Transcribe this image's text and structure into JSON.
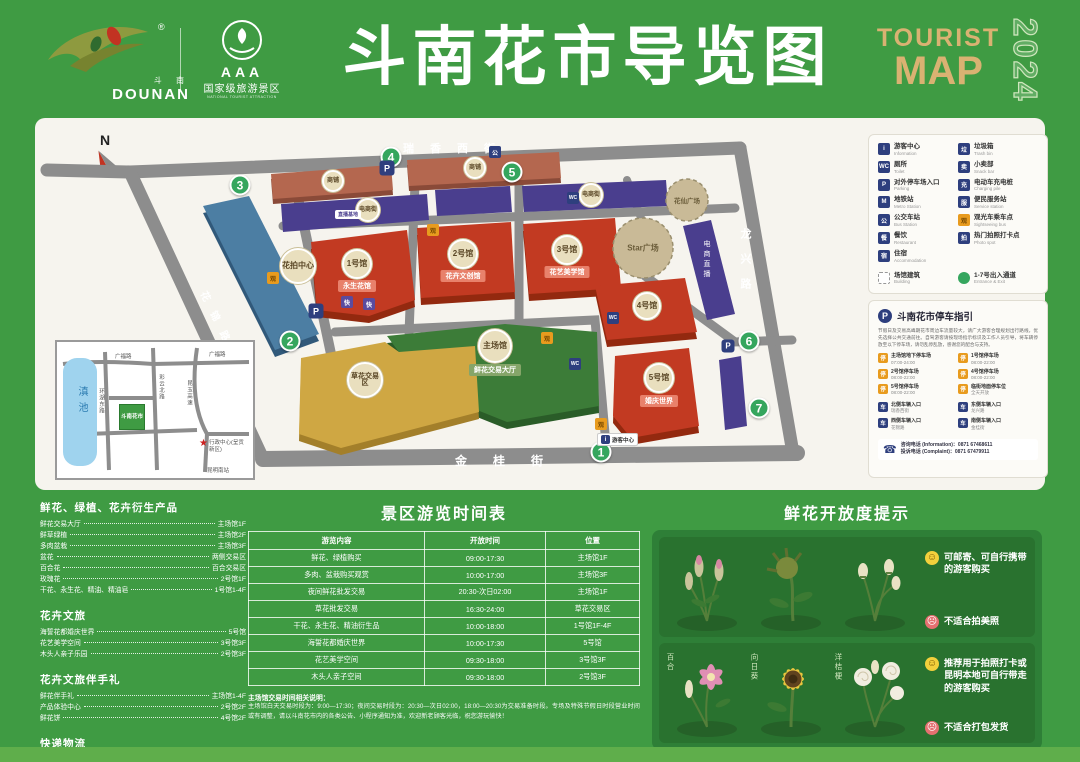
{
  "header": {
    "logo": {
      "cn": "斗 南",
      "en": "DOUNAN",
      "reg": "®"
    },
    "aaa": {
      "grade": "AAA",
      "cn": "国家级旅游景区",
      "en": "NATIONAL TOURIST ATTRACTION"
    },
    "title": "斗南花市导览图",
    "tourist": "TOURIST",
    "map_word": "MAP",
    "year": "2024"
  },
  "icons": {
    "info": "i",
    "toilet": "WC",
    "parking": "P",
    "metro": "M",
    "bus": "公",
    "restaurant": "餐",
    "hotel": "宿",
    "trash": "垃",
    "snack": "卖",
    "charge": "充",
    "service": "服",
    "sight": "观",
    "photo": "拍",
    "gate": "车",
    "lot": "停",
    "express": "快",
    "phone": "☎",
    "star": "★"
  },
  "map": {
    "compass": "N",
    "streets": {
      "top": "瑞香西街",
      "bottom": "金桂街",
      "right": "龙兴路",
      "left": "花锦路"
    },
    "entrances": [
      "1",
      "2",
      "3",
      "4",
      "5",
      "6",
      "7"
    ],
    "buildings": {
      "blue": {
        "badge": "花拍中心"
      },
      "salmon_a": {
        "badge": "商铺"
      },
      "salmon_b": {
        "badge": "商铺"
      },
      "purple1": {
        "badge": "电商街"
      },
      "purple2": {
        "badge": "电商街"
      },
      "ecommerce": {
        "label": "直播基地",
        "side": "电商直播"
      },
      "hall1": {
        "badge": "1号馆",
        "banner": "永生花馆"
      },
      "hall2": {
        "badge": "2号馆",
        "banner": "花卉文创馆"
      },
      "hall3": {
        "badge": "3号馆",
        "banner": "花艺美学馆"
      },
      "hall4": {
        "badge": "4号馆"
      },
      "hall5": {
        "badge": "5号馆",
        "banner": "婚庆世界"
      },
      "main": {
        "badge": "主场馆",
        "banner": "鲜花交易大厅"
      },
      "yellow": {
        "badge": "草花交易区"
      },
      "plaza_star": {
        "label": "Star广场"
      },
      "plaza_small": {
        "label": "花仙广场"
      }
    },
    "poi": {
      "visitor_center": "游客中心"
    },
    "inset": {
      "lake": "滇池",
      "road_tl": "广福路",
      "road_tr": "广福路",
      "road_left": "环湖东路",
      "road_mid": "彩云北路",
      "road_right": "昆玉高速",
      "marker": "斗南花市",
      "star_label": "行政中心(呈贡新区)",
      "station": "昆明南站"
    }
  },
  "legend": {
    "left": [
      {
        "cn": "游客中心",
        "en": "Information"
      },
      {
        "cn": "厕所",
        "en": "Toilet"
      },
      {
        "cn": "对外停车场入口",
        "en": "Parking"
      },
      {
        "cn": "地铁站",
        "en": "Metro Station"
      },
      {
        "cn": "公交车站",
        "en": "Bus Station"
      },
      {
        "cn": "餐饮",
        "en": "Restaurant"
      },
      {
        "cn": "住宿",
        "en": "Accommodation"
      }
    ],
    "right": [
      {
        "cn": "垃圾箱",
        "en": "Trash bin"
      },
      {
        "cn": "小卖部",
        "en": "Snack bar"
      },
      {
        "cn": "电动车充电桩",
        "en": "Charging pile"
      },
      {
        "cn": "便民服务站",
        "en": "Service station"
      },
      {
        "cn": "观光车乘车点",
        "en": "Sightseeing bus"
      },
      {
        "cn": "热门拍照打卡点",
        "en": "Photo spot"
      }
    ],
    "bottom": [
      {
        "cn": "场馆建筑",
        "en": "Building"
      },
      {
        "cn": "1-7号出入通道",
        "en": "Entrance & Exit"
      }
    ]
  },
  "parking": {
    "title": "斗南花市停车指引",
    "intro": "节假日及交易高峰期花市周边车流量较大，请广大游客合理规划出行路线，优先选择公共交通前往。自驾游客请按现场指示标识及工作人员引导，将车辆停放至以下停车场，请勿乱停乱放，感谢您的配合与支持。",
    "lots": [
      {
        "name": "主场馆地下停车场",
        "time": "07:00-24:00"
      },
      {
        "name": "1号馆停车场",
        "time": "08:00-22:00"
      },
      {
        "name": "2号馆停车场",
        "time": "08:00-22:00"
      },
      {
        "name": "4号馆停车场",
        "time": "08:00-22:00"
      },
      {
        "name": "5号馆停车场",
        "time": "08:00-22:00"
      },
      {
        "name": "临街地面停车位",
        "time": "全天开放"
      }
    ],
    "gates": [
      {
        "name": "北侧车辆入口",
        "road": "瑞香西街"
      },
      {
        "name": "东侧车辆入口",
        "road": "龙兴路"
      },
      {
        "name": "西侧车辆入口",
        "road": "花锦路"
      },
      {
        "name": "南侧车辆入口",
        "road": "金桂街"
      }
    ],
    "phones": {
      "info_line": "咨询电话 (Information)：0871 67468611",
      "complaint_line": "投诉电话 (Complaint)：0871 67479911"
    }
  },
  "products": {
    "s1": {
      "title": "鲜花、绿植、花卉衍生产品",
      "items": [
        {
          "n": "鲜花交易大厅",
          "l": "主场馆1F"
        },
        {
          "n": "鲜草绿植",
          "l": "主场馆2F"
        },
        {
          "n": "多肉盆栽",
          "l": "主场馆3F"
        },
        {
          "n": "盆花",
          "l": "两侧交易区"
        },
        {
          "n": "百合花",
          "l": "百合交易区"
        },
        {
          "n": "玫瑰花",
          "l": "2号馆1F"
        },
        {
          "n": "干花、永生花、精油、精油皂",
          "l": "1号馆1-4F"
        }
      ]
    },
    "s2": {
      "title": "花卉文旅",
      "items": [
        {
          "n": "海誓花都婚庆世界",
          "l": "5号馆"
        },
        {
          "n": "花艺美学空间",
          "l": "3号馆3F"
        },
        {
          "n": "木头人亲子乐园",
          "l": "2号馆3F"
        }
      ]
    },
    "s3": {
      "title": "花卉文旅伴手礼",
      "items": [
        {
          "n": "鲜花伴手礼",
          "l": "主场馆1-4F"
        },
        {
          "n": "产品体验中心",
          "l": "2号馆2F"
        },
        {
          "n": "鲜花饼",
          "l": "4号馆2F"
        }
      ]
    },
    "s4": {
      "title": "快递物流",
      "items": [
        {
          "n": "中通快递",
          "l": "主场馆1F"
        },
        {
          "n": "申通快递",
          "l": "1号馆1F"
        },
        {
          "n": "顺丰快递",
          "l": "1号馆1F"
        },
        {
          "n": "韵达快递",
          "l": "2号馆1F"
        }
      ]
    }
  },
  "schedule": {
    "title": "景区游览时间表",
    "headers": [
      "游览内容",
      "开放时间",
      "位置"
    ],
    "rows": [
      [
        "鲜花、绿植购买",
        "09:00-17:30",
        "主场馆1F"
      ],
      [
        "多肉、盆栽购买观赏",
        "10:00-17:00",
        "主场馆3F"
      ],
      [
        "夜间鲜花批发交易",
        "20:30-次日02:00",
        "主场馆1F"
      ],
      [
        "草花批发交易",
        "16:30-24:00",
        "草花交易区"
      ],
      [
        "干花、永生花、精油衍生品",
        "10:00-18:00",
        "1号馆1F-4F"
      ],
      [
        "海誓花都婚庆世界",
        "10:00-17:30",
        "5号馆"
      ],
      [
        "花艺美学空间",
        "09:30-18:00",
        "3号馆3F"
      ],
      [
        "木头人亲子空间",
        "09:30-18:00",
        "2号馆3F"
      ]
    ],
    "note_title": "主场馆交易时间相关说明：",
    "note": "主场馆白天交易时段为：9:00—17:30；夜间交易时段为：20:30—次日02:00，18:00—20:30为交易准备时段。专场及特殊节假日时段营业时间或有调整，请以斗南花市内的各类公告、小程序通知为准，欢迎新老顾客光临，祝您游玩愉快！"
  },
  "freshness": {
    "title": "鲜花开放度提示",
    "flowers": [
      "百合",
      "向日葵",
      "洋桔梗"
    ],
    "row1_good": "可邮寄、可自行携带的游客购买",
    "row1_bad": "不适合拍美照",
    "row2_good": "推荐用于拍照打卡或昆明本地可自行带走的游客购买",
    "row2_bad": "不适合打包发货"
  }
}
